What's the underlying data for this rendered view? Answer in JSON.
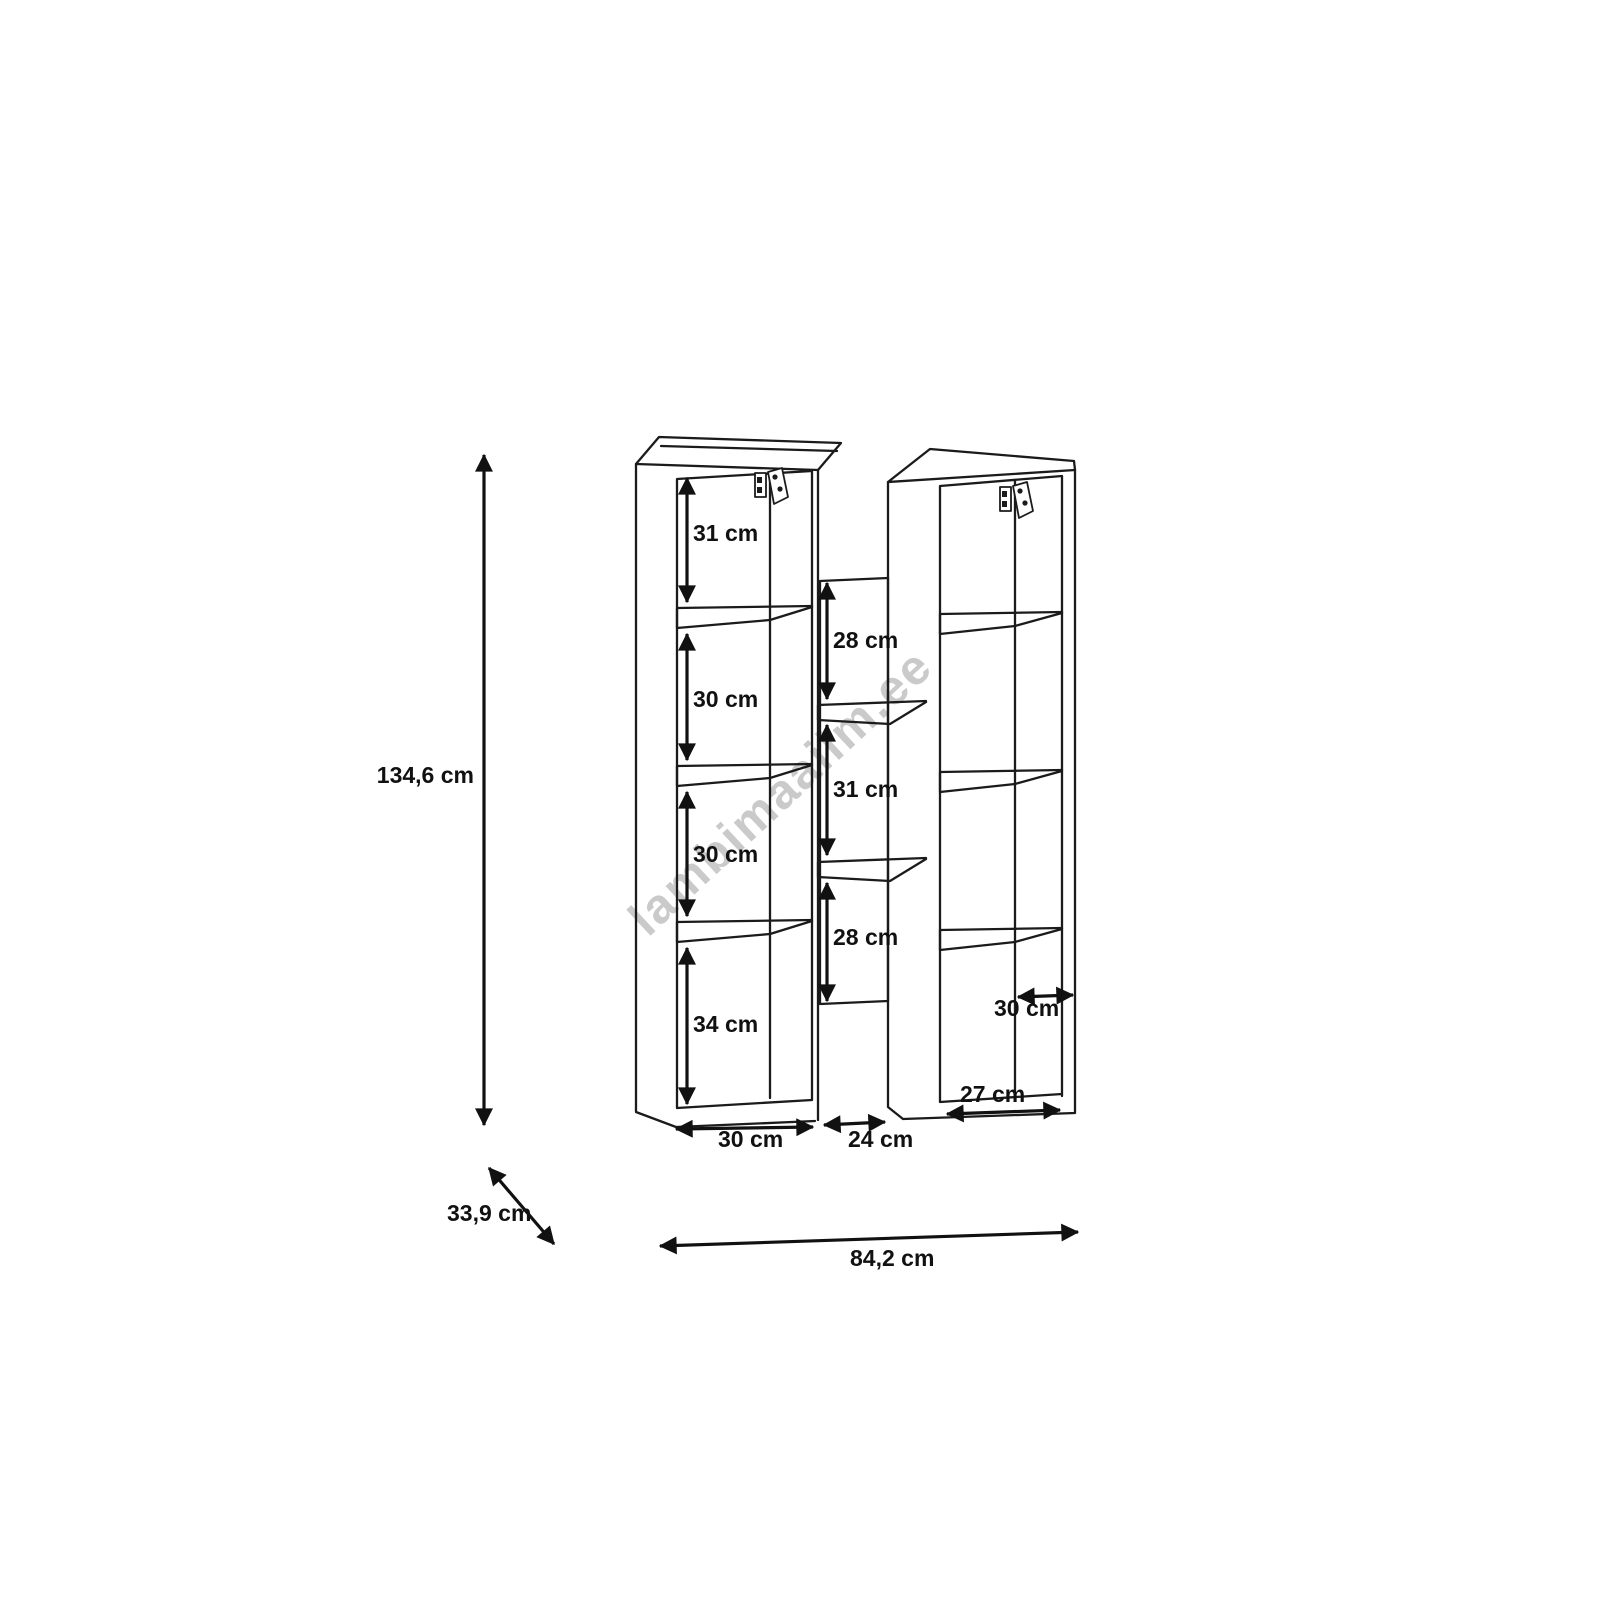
{
  "watermark": {
    "text": "lambimaailm.ee",
    "color": "#c5c5c5"
  },
  "colors": {
    "line": "#111111",
    "background": "#ffffff"
  },
  "dims": {
    "height": "134,6 cm",
    "depth": "33,9 cm",
    "total_width": "84,2 cm",
    "left_cells": [
      "31 cm",
      "30 cm",
      "30 cm",
      "34 cm"
    ],
    "middle_cells": [
      "28 cm",
      "31 cm",
      "28 cm"
    ],
    "left_width": "30 cm",
    "middle_width": "24 cm",
    "right_inner_width": "30 cm",
    "right_bottom_width": "27 cm"
  }
}
